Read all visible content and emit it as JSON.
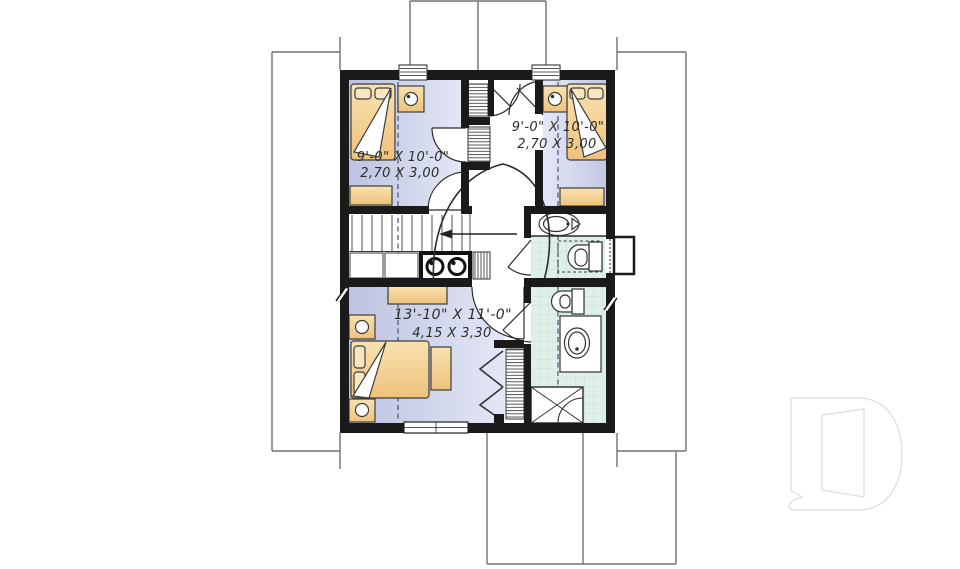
{
  "plan": {
    "type": "second-floor-plan",
    "rooms": [
      {
        "name": "bedroom-upper-left",
        "dims_ft": "9'-0\" X 10'-0\"",
        "dims_m": "2,70 X 3,00"
      },
      {
        "name": "bedroom-upper-right",
        "dims_ft": "9'-0\" X 10'-0\"",
        "dims_m": "2,70 X 3,00"
      },
      {
        "name": "bedroom-lower",
        "dims_ft": "13'-10\" X 11'-0\"",
        "dims_m": "4,15 X 3,30"
      }
    ],
    "features": [
      "staircase-down-arrow",
      "washer-dryer-pair",
      "bathroom-upper",
      "bathroom-lower",
      "closets-hatched",
      "dormer-roof-outline"
    ],
    "watermark": {
      "letter": "D"
    },
    "colors": {
      "wall": "#1a1a1a",
      "bedroom_floor_dark": "#bcc2e1",
      "bedroom_floor_light": "#e4e7f5",
      "bath_floor": "#def0e7",
      "tile_line": "#c2ddcf",
      "furniture_dark": "#eec27c",
      "furniture_light": "#f9e2b0",
      "roof_line": "#707070",
      "dashed_line": "#47537c",
      "watermark_stroke": "#dedede"
    }
  }
}
